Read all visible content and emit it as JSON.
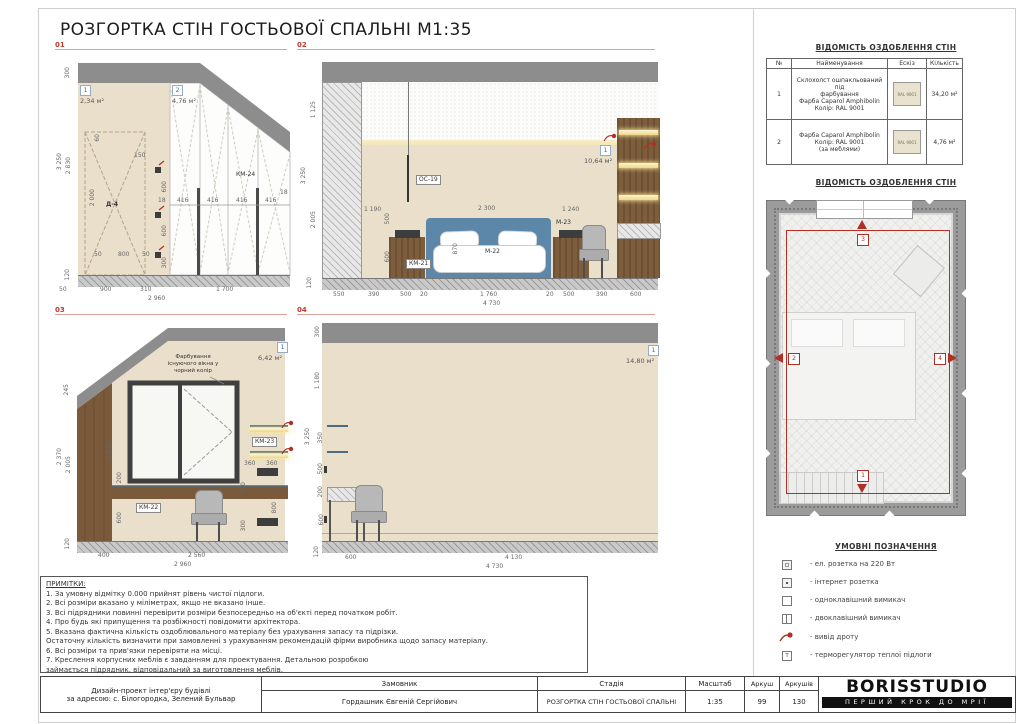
{
  "sheet": {
    "title": "РОЗГОРТКА СТІН ГОСТЬОВОЇ СПАЛЬНІ М1:35"
  },
  "colors": {
    "accent_red": "#c0392b",
    "line_red": "#dfa099",
    "marker_blue": "#3a66a6",
    "wall_beige": "#eadfcb",
    "ceiling_gray": "#8d8d8d",
    "wood_brown": "#7a5a3b",
    "bed_blue": "#5d87a8",
    "ral_9001": "#e9e2cf"
  },
  "e01": {
    "label": "01",
    "marker1": "1",
    "area1": "2,34 м²",
    "marker2": "2",
    "area2": "4,76 м²",
    "door_label": "Д-4",
    "km24": "КМ-24",
    "left_dims": [
      "300",
      "3 250",
      "2 830",
      "120"
    ],
    "door_dims": {
      "h": "2 000",
      "w": "800",
      "s1": "50",
      "s2": "50",
      "top": "60",
      "off": "150"
    },
    "socket_dims": [
      "600",
      "600",
      "300"
    ],
    "shelf_dims": [
      "18",
      "416",
      "416",
      "416",
      "416",
      "18"
    ],
    "bottom_dims": [
      "50",
      "900",
      "310",
      "1 700"
    ],
    "total": "2 960"
  },
  "e02": {
    "label": "02",
    "marker1": "1",
    "area1": "10,64 м²",
    "oc19": "ОС-19",
    "km21": "КМ-21",
    "m22": "М-22",
    "m23": "М-23",
    "left_dims": [
      "1 125",
      "3 250",
      "2 005",
      "120"
    ],
    "inner_dims": {
      "a": "1 190",
      "b": "500",
      "c": "600",
      "bed_w": "2 300",
      "bed_h": "870",
      "right": "1 240"
    },
    "bottom_dims": [
      "550",
      "390",
      "500",
      "20",
      "1 760",
      "20",
      "500",
      "390",
      "600"
    ],
    "total": "4 730"
  },
  "e03": {
    "label": "03",
    "marker1": "1",
    "area1": "6,42 м²",
    "note": "Фарбування\nіснуючого вікна у\nчорний колір",
    "km23": "КМ-23",
    "km22": "КМ-22",
    "left_dims": [
      "245",
      "2 370",
      "2 005",
      "120"
    ],
    "inner_dims": [
      "2 275",
      "200",
      "600"
    ],
    "right_dims": [
      "360",
      "360",
      "700",
      "800",
      "300"
    ],
    "bottom_dims": [
      "400",
      "2 560"
    ],
    "total": "2 960"
  },
  "e04": {
    "label": "04",
    "marker1": "1",
    "area1": "14,80 м²",
    "left_dims": [
      "300",
      "1 180",
      "3 250",
      "350",
      "500",
      "200",
      "600",
      "120"
    ],
    "bottom_dims": [
      "600",
      "4 130"
    ],
    "total": "4 730"
  },
  "finish_table": {
    "heading": "ВІДОМІСТЬ ОЗДОБЛЕННЯ СТІН",
    "columns": [
      "№",
      "Найменування",
      "Ескіз",
      "Кількість"
    ],
    "rows": [
      {
        "num": "1",
        "name": "Склохолст ошпакльований під\nфарбування\nФарба Caparol Amphibolin\nКолір: RAL 9001",
        "swatch": "RAL 9001",
        "qty": "34,20 м²"
      },
      {
        "num": "2",
        "name": "Фарба Caparol Amphibolin\nКолір: RAL 9001\n(за меблями)",
        "swatch": "RAL 9001",
        "qty": "4,76 м²"
      }
    ]
  },
  "plan": {
    "heading": "ВІДОМІСТЬ ОЗДОБЛЕННЯ СТІН",
    "markers": [
      "1",
      "2",
      "3",
      "4"
    ]
  },
  "legend": {
    "heading": "УМОВНІ ПОЗНАЧЕННЯ",
    "thermostat_letter": "Т",
    "items": [
      {
        "icon": "outlet-220-icon",
        "text": "- ел. розетка на 220 Вт"
      },
      {
        "icon": "internet-outlet-icon",
        "text": "- інтернет розетка"
      },
      {
        "icon": "single-switch-icon",
        "text": "- одноклавішний вимикач"
      },
      {
        "icon": "double-switch-icon",
        "text": "- двоклавішний вимикач"
      },
      {
        "icon": "wire-outlet-icon",
        "text": "- вивід дроту"
      },
      {
        "icon": "floor-thermostat-icon",
        "text": "- терморегулятор теплої підлоги"
      }
    ]
  },
  "notes": {
    "title": "ПРИМІТКИ:",
    "lines": [
      "1. За умовну відмітку 0.000 прийнят рівень чистої підлоги.",
      "2. Всі розміри вказано у міліметрах, якщо не вказано інше.",
      "3. Всі підрядники повинні перевірити розміри безпосередньо на об'єкті перед початком робіт.",
      "4. Про будь які припущення та розбіжності повідомити архітектора.",
      "5. Вказана фактична кількість оздоблювального матеріалу без урахування запасу та підрізки.",
      "Остаточну кількість визначити при замовленні з урахуванням рекомендацій фірми виробника щодо запасу матеріалу.",
      "6. Всі розміри та прив'язки перевіряти на місці.",
      "7. Креслення корпусних меблів є завданням для проектування. Детальною розробкою",
      "займається підрядник, відповідальний за виготовлення меблів."
    ]
  },
  "titleblock": {
    "project": "Дизайн-проект інтер'єру будівлі\nза адресою: с. Білогородка, Зелений Бульвар",
    "customer_label": "Замовник",
    "customer": "Гордашник Євгеній Сергійович",
    "stage_label": "Стадія",
    "doc_title": "РОЗГОРТКА СТІН ГОСТЬОВОЇ СПАЛЬНІ",
    "scale_label": "Масштаб",
    "scale": "1:35",
    "sheet_label": "Аркуш",
    "sheet_no": "99",
    "sheets_label": "Аркушів",
    "sheets_total": "130",
    "logo": "BORISSTUDIO",
    "tagline": "ПЕРШИЙ КРОК ДО МРІЇ"
  }
}
